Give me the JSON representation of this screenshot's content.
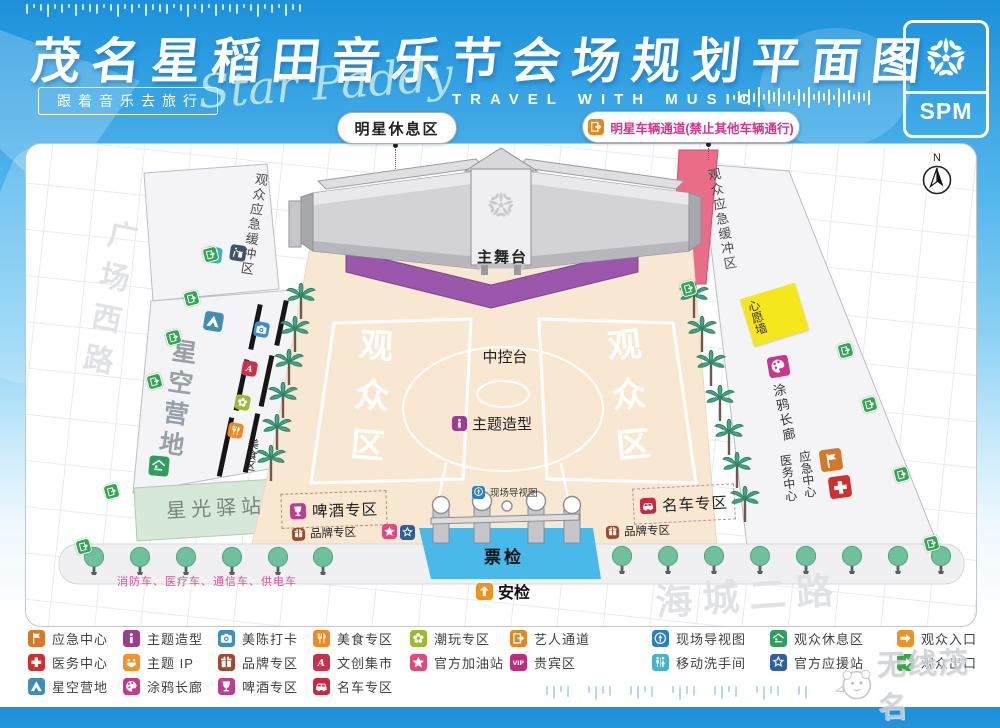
{
  "header": {
    "title": "茂名星稻田音乐节会场规划平面图",
    "tagline_cn": "跟着音乐去旅行",
    "tagline_script": "Star Paddy",
    "tagline_en": "TRAVEL WITH MUSIC",
    "logo_text": "SPM"
  },
  "callouts": {
    "star_lounge": "明星休息区",
    "star_vehicle": "明星车辆通道(禁止其他车辆通行)"
  },
  "compass": "N",
  "accent_colors": {
    "header_blue": "#1c90da",
    "stage_purple": "#9a57ac",
    "ticket_blue": "#49b9e9",
    "vip_road_pink": "#e96d87",
    "floor_beige": "#f8e8d1",
    "wish_wall_yellow": "#f6e71c",
    "tree_green": "#6fc09c"
  },
  "map": {
    "roads": {
      "west": "广场西路",
      "south": "海城二路"
    },
    "labels": {
      "buffer_left": "观众应急缓冲区",
      "buffer_right": "观众应急缓冲区",
      "star_camp": "星空营地",
      "star_station": "星光驿站",
      "food_street": "美食区",
      "main_stage": "主舞台",
      "audience_left": "观众区",
      "audience_right": "观众区",
      "control_desk": "中控台",
      "theme_sculpture": "主题造型",
      "wish_wall": "心愿墙",
      "graffiti_gallery": "涂鸦长廊",
      "emergency_center": "应急中心",
      "medical_center": "医务中心",
      "ticket_check": "票检",
      "security_check": "安检",
      "site_map": "现场导视图",
      "beer_zone": "啤酒专区",
      "car_zone": "名车专区",
      "brand_zone_left": "品牌专区",
      "brand_zone_right": "品牌专区",
      "support_vehicles": "消防车、医疗车、通信车、供电车"
    },
    "icons": {
      "toilet": {
        "icon": "toilet",
        "color": "#45b5c4"
      },
      "litter": {
        "icon": "litter",
        "color": "#3e5468"
      },
      "tent": {
        "icon": "tent",
        "color": "#3f8fb0"
      },
      "camera": {
        "icon": "camera",
        "color": "#3f8ec7"
      },
      "market": {
        "icon": "letter-a",
        "color": "#c9304c"
      },
      "toy": {
        "icon": "flower",
        "color": "#9cba2f"
      },
      "food": {
        "icon": "food",
        "color": "#ef8a21"
      },
      "rest": {
        "icon": "rest",
        "color": "#2f9e5e"
      },
      "palette": {
        "icon": "palette",
        "color": "#c8368e"
      },
      "emergency": {
        "icon": "flag",
        "color": "#d4782a"
      },
      "medical": {
        "icon": "cross",
        "color": "#d02f2f"
      },
      "beer": {
        "icon": "beer",
        "color": "#bd3d8e"
      },
      "brand": {
        "icon": "gift",
        "color": "#9e4a2f"
      },
      "car": {
        "icon": "car",
        "color": "#c92843"
      },
      "fuel_star": {
        "icon": "star",
        "color": "#e0487e"
      },
      "support_star": {
        "icon": "star-badge",
        "color": "#2d5fa3"
      },
      "nav": {
        "icon": "nav",
        "color": "#2b7fc3"
      },
      "security": {
        "icon": "arrow-up",
        "color": "#f0921e"
      },
      "exit": {
        "icon": "door",
        "color": "#2fa84f"
      },
      "artist_door": {
        "icon": "door",
        "color": "#e8851f"
      },
      "theme": {
        "icon": "info",
        "color": "#9a3d90"
      }
    }
  },
  "legend": {
    "columns": [
      [
        {
          "label": "应急中心",
          "icon": "flag",
          "color": "#d4782a"
        },
        {
          "label": "医务中心",
          "icon": "cross",
          "color": "#d02f2f"
        },
        {
          "label": "星空营地",
          "icon": "tent",
          "color": "#3f8fb0"
        }
      ],
      [
        {
          "label": "主题造型",
          "icon": "info",
          "color": "#9a3d90"
        },
        {
          "label": "主题 IP",
          "icon": "smile",
          "color": "#f0932b"
        },
        {
          "label": "涂鸦长廊",
          "icon": "palette",
          "color": "#c8368e"
        }
      ],
      [
        {
          "label": "美陈打卡",
          "icon": "camera",
          "color": "#3f8ec7"
        },
        {
          "label": "品牌专区",
          "icon": "gift",
          "color": "#9e4a2f"
        },
        {
          "label": "啤酒专区",
          "icon": "beer",
          "color": "#bd3d8e"
        }
      ],
      [
        {
          "label": "美食专区",
          "icon": "food",
          "color": "#ef8a21"
        },
        {
          "label": "文创集市",
          "icon": "letter-a",
          "color": "#c9304c"
        },
        {
          "label": "名车专区",
          "icon": "car",
          "color": "#c92843"
        }
      ],
      [
        {
          "label": "潮玩专区",
          "icon": "flower",
          "color": "#9cba2f"
        },
        {
          "label": "官方加油站",
          "icon": "star",
          "color": "#e0487e"
        }
      ],
      [
        {
          "label": "艺人通道",
          "icon": "door",
          "color": "#e8851f"
        },
        {
          "label": "贵宾区",
          "icon": "vip",
          "color": "#c02a80"
        }
      ],
      [
        {
          "label": "现场导视图",
          "icon": "nav",
          "color": "#2b7fc3"
        },
        {
          "label": "移动洗手间",
          "icon": "toilet",
          "color": "#45b5c4"
        }
      ],
      [
        {
          "label": "观众休息区",
          "icon": "rest",
          "color": "#2f9e5e"
        },
        {
          "label": "官方应援站",
          "icon": "star-badge",
          "color": "#2d5fa3"
        }
      ],
      [
        {
          "label": "观众入口",
          "icon": "arrow-right",
          "color": "#f0921e"
        },
        {
          "label": "观众出口",
          "icon": "arrow-right",
          "color": "#3aa648"
        }
      ]
    ]
  },
  "watermark": "无线茂名"
}
